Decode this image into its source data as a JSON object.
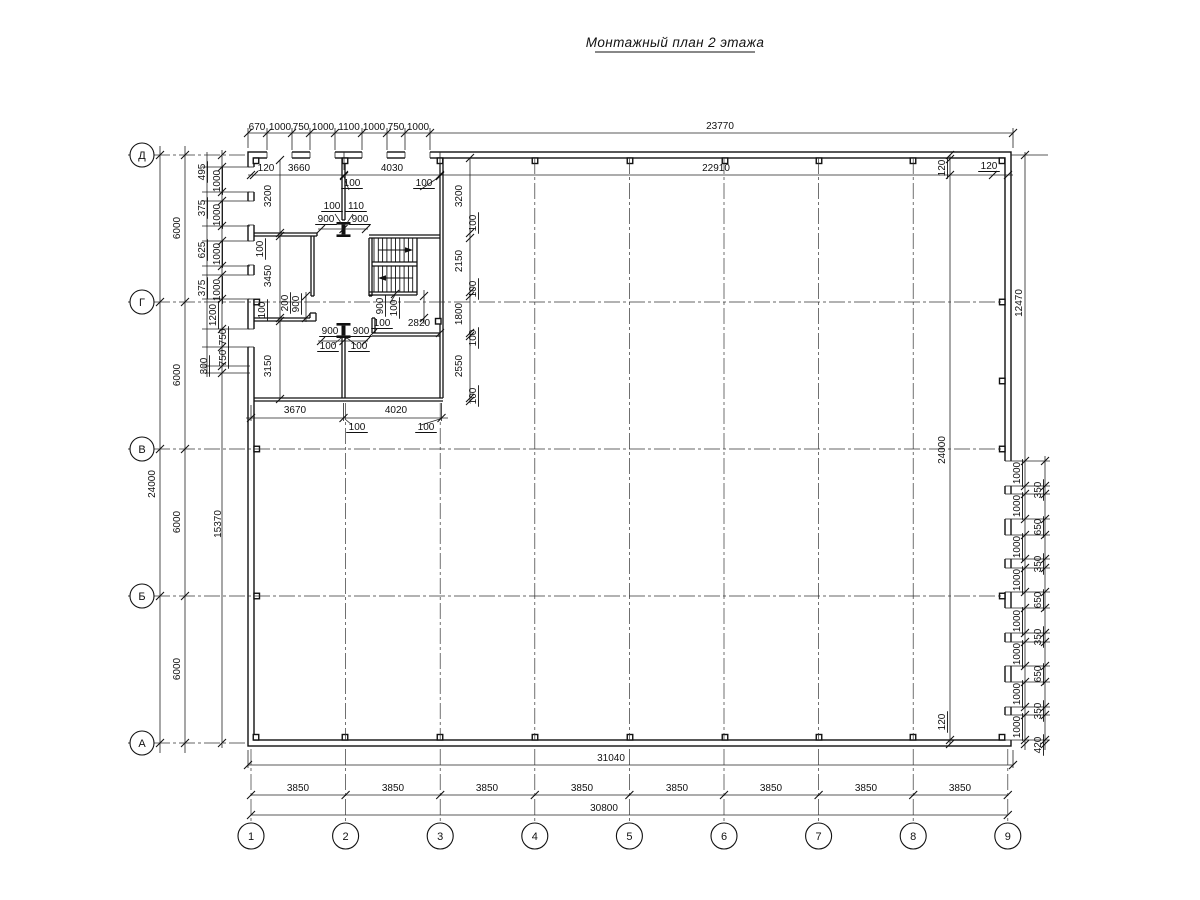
{
  "title": "Монтажный план 2 этажа",
  "drawing": {
    "row_axes": [
      "Д",
      "Г",
      "В",
      "Б",
      "А"
    ],
    "col_axes": [
      "1",
      "2",
      "3",
      "4",
      "5",
      "6",
      "7",
      "8",
      "9"
    ],
    "labels": [
      {
        "t": "670",
        "x": 257,
        "y": 130,
        "s": 9
      },
      {
        "t": "1000",
        "x": 280,
        "y": 130,
        "s": 9
      },
      {
        "t": "750",
        "x": 301,
        "y": 130,
        "s": 9
      },
      {
        "t": "1000",
        "x": 323,
        "y": 130,
        "s": 9
      },
      {
        "t": "1100",
        "x": 349,
        "y": 130,
        "s": 9
      },
      {
        "t": "1000",
        "x": 374,
        "y": 130,
        "s": 9
      },
      {
        "t": "750",
        "x": 396,
        "y": 130,
        "s": 9
      },
      {
        "t": "1000",
        "x": 418,
        "y": 130,
        "s": 9
      },
      {
        "t": "23770",
        "x": 720,
        "y": 129
      },
      {
        "t": "120",
        "x": 266,
        "y": 171
      },
      {
        "t": "3660",
        "x": 299,
        "y": 171
      },
      {
        "t": "4030",
        "x": 392,
        "y": 171
      },
      {
        "t": "22910",
        "x": 716,
        "y": 171
      },
      {
        "t": "120",
        "x": 989,
        "y": 169,
        "u": 1
      },
      {
        "t": "120",
        "x": 945,
        "y": 168,
        "r": -90,
        "u": 1
      },
      {
        "t": "24000",
        "x": 945,
        "y": 450,
        "r": -90
      },
      {
        "t": "120",
        "x": 945,
        "y": 722,
        "r": -90,
        "u": 1
      },
      {
        "t": "12470",
        "x": 1022,
        "y": 303,
        "r": -90
      },
      {
        "t": "1000",
        "x": 1020,
        "y": 473,
        "r": -90,
        "u": 1
      },
      {
        "t": "350",
        "x": 1041,
        "y": 490,
        "r": -90,
        "u": 1
      },
      {
        "t": "1000",
        "x": 1020,
        "y": 506,
        "r": -90,
        "u": 1
      },
      {
        "t": "650",
        "x": 1041,
        "y": 527,
        "r": -90,
        "u": 1
      },
      {
        "t": "1000",
        "x": 1020,
        "y": 547,
        "r": -90,
        "u": 1
      },
      {
        "t": "350",
        "x": 1041,
        "y": 564,
        "r": -90,
        "u": 1
      },
      {
        "t": "1000",
        "x": 1020,
        "y": 580,
        "r": -90,
        "u": 1
      },
      {
        "t": "650",
        "x": 1041,
        "y": 600,
        "r": -90,
        "u": 1
      },
      {
        "t": "1000",
        "x": 1020,
        "y": 621,
        "r": -90,
        "u": 1
      },
      {
        "t": "350",
        "x": 1041,
        "y": 637,
        "r": -90,
        "u": 1
      },
      {
        "t": "1000",
        "x": 1020,
        "y": 654,
        "r": -90,
        "u": 1
      },
      {
        "t": "650",
        "x": 1041,
        "y": 674,
        "r": -90,
        "u": 1
      },
      {
        "t": "1000",
        "x": 1020,
        "y": 694,
        "r": -90,
        "u": 1
      },
      {
        "t": "350",
        "x": 1041,
        "y": 711,
        "r": -90,
        "u": 1
      },
      {
        "t": "1000",
        "x": 1020,
        "y": 727,
        "r": -90,
        "u": 1
      },
      {
        "t": "420",
        "x": 1041,
        "y": 745,
        "r": -90,
        "u": 1
      },
      {
        "t": "24000",
        "x": 155,
        "y": 484,
        "r": -90
      },
      {
        "t": "6000",
        "x": 180,
        "y": 228,
        "r": -90
      },
      {
        "t": "6000",
        "x": 180,
        "y": 375,
        "r": -90
      },
      {
        "t": "6000",
        "x": 180,
        "y": 522,
        "r": -90
      },
      {
        "t": "6000",
        "x": 180,
        "y": 669,
        "r": -90
      },
      {
        "t": "495",
        "x": 205,
        "y": 172,
        "r": -90,
        "u": 1
      },
      {
        "t": "1000",
        "x": 220,
        "y": 181,
        "r": -90,
        "u": 1
      },
      {
        "t": "375",
        "x": 205,
        "y": 208,
        "r": -90,
        "u": 1
      },
      {
        "t": "1000",
        "x": 220,
        "y": 215,
        "r": -90,
        "u": 1
      },
      {
        "t": "625",
        "x": 205,
        "y": 250,
        "r": -90,
        "u": 1
      },
      {
        "t": "1000",
        "x": 220,
        "y": 254,
        "r": -90,
        "u": 1
      },
      {
        "t": "375",
        "x": 205,
        "y": 288,
        "r": -90,
        "u": 1
      },
      {
        "t": "1000",
        "x": 220,
        "y": 290,
        "r": -90,
        "u": 1
      },
      {
        "t": "1200",
        "x": 216,
        "y": 315,
        "r": -90,
        "u": 1
      },
      {
        "t": "750",
        "x": 226,
        "y": 337,
        "r": -90,
        "u": 1
      },
      {
        "t": "750",
        "x": 226,
        "y": 358,
        "r": -90,
        "u": 1
      },
      {
        "t": "300",
        "x": 207,
        "y": 366,
        "r": -90,
        "u": 1
      },
      {
        "t": "15370",
        "x": 221,
        "y": 524,
        "r": -90
      },
      {
        "t": "3200",
        "x": 271,
        "y": 196,
        "r": -90
      },
      {
        "t": "100",
        "x": 263,
        "y": 249,
        "r": -90,
        "u": 1
      },
      {
        "t": "3450",
        "x": 271,
        "y": 276,
        "r": -90
      },
      {
        "t": "100",
        "x": 265,
        "y": 310,
        "r": -90,
        "u": 1
      },
      {
        "t": "3150",
        "x": 271,
        "y": 366,
        "r": -90
      },
      {
        "t": "3200",
        "x": 462,
        "y": 196,
        "r": -90
      },
      {
        "t": "100",
        "x": 476,
        "y": 223,
        "r": -90,
        "u": 1
      },
      {
        "t": "2150",
        "x": 462,
        "y": 261,
        "r": -90
      },
      {
        "t": "100",
        "x": 476,
        "y": 289,
        "r": -90,
        "u": 1
      },
      {
        "t": "1800",
        "x": 462,
        "y": 314,
        "r": -90
      },
      {
        "t": "100",
        "x": 476,
        "y": 338,
        "r": -90,
        "u": 1
      },
      {
        "t": "2550",
        "x": 462,
        "y": 366,
        "r": -90
      },
      {
        "t": "100",
        "x": 476,
        "y": 396,
        "r": -90,
        "u": 1
      },
      {
        "t": "100",
        "x": 352,
        "y": 186,
        "u": 1
      },
      {
        "t": "100",
        "x": 424,
        "y": 186,
        "u": 1
      },
      {
        "t": "100",
        "x": 332,
        "y": 209,
        "u": 1
      },
      {
        "t": "110",
        "x": 356,
        "y": 209,
        "u": 1
      },
      {
        "t": "900",
        "x": 326,
        "y": 222,
        "u": 1
      },
      {
        "t": "900",
        "x": 360,
        "y": 222,
        "u": 1
      },
      {
        "t": "200",
        "x": 288,
        "y": 303,
        "r": -90,
        "u": 1
      },
      {
        "t": "900",
        "x": 299,
        "y": 304,
        "r": -90,
        "u": 1
      },
      {
        "t": "900",
        "x": 383,
        "y": 306,
        "r": -90,
        "u": 1
      },
      {
        "t": "100",
        "x": 397,
        "y": 308,
        "r": -90,
        "u": 1
      },
      {
        "t": "100",
        "x": 382,
        "y": 326,
        "u": 1
      },
      {
        "t": "2820",
        "x": 419,
        "y": 326
      },
      {
        "t": "900",
        "x": 330,
        "y": 334,
        "u": 1
      },
      {
        "t": "900",
        "x": 361,
        "y": 334,
        "u": 1
      },
      {
        "t": "100",
        "x": 328,
        "y": 349,
        "u": 1
      },
      {
        "t": "100",
        "x": 359,
        "y": 349,
        "u": 1
      },
      {
        "t": "3670",
        "x": 295,
        "y": 413
      },
      {
        "t": "4020",
        "x": 396,
        "y": 413
      },
      {
        "t": "100",
        "x": 357,
        "y": 430,
        "u": 1
      },
      {
        "t": "100",
        "x": 426,
        "y": 430,
        "u": 1
      },
      {
        "t": "31040",
        "x": 611,
        "y": 761
      },
      {
        "t": "3850",
        "x": 298,
        "y": 791
      },
      {
        "t": "3850",
        "x": 393,
        "y": 791
      },
      {
        "t": "3850",
        "x": 487,
        "y": 791
      },
      {
        "t": "3850",
        "x": 582,
        "y": 791
      },
      {
        "t": "3850",
        "x": 677,
        "y": 791
      },
      {
        "t": "3850",
        "x": 771,
        "y": 791
      },
      {
        "t": "3850",
        "x": 866,
        "y": 791
      },
      {
        "t": "3850",
        "x": 960,
        "y": 791
      },
      {
        "t": "30800",
        "x": 604,
        "y": 811
      }
    ]
  }
}
